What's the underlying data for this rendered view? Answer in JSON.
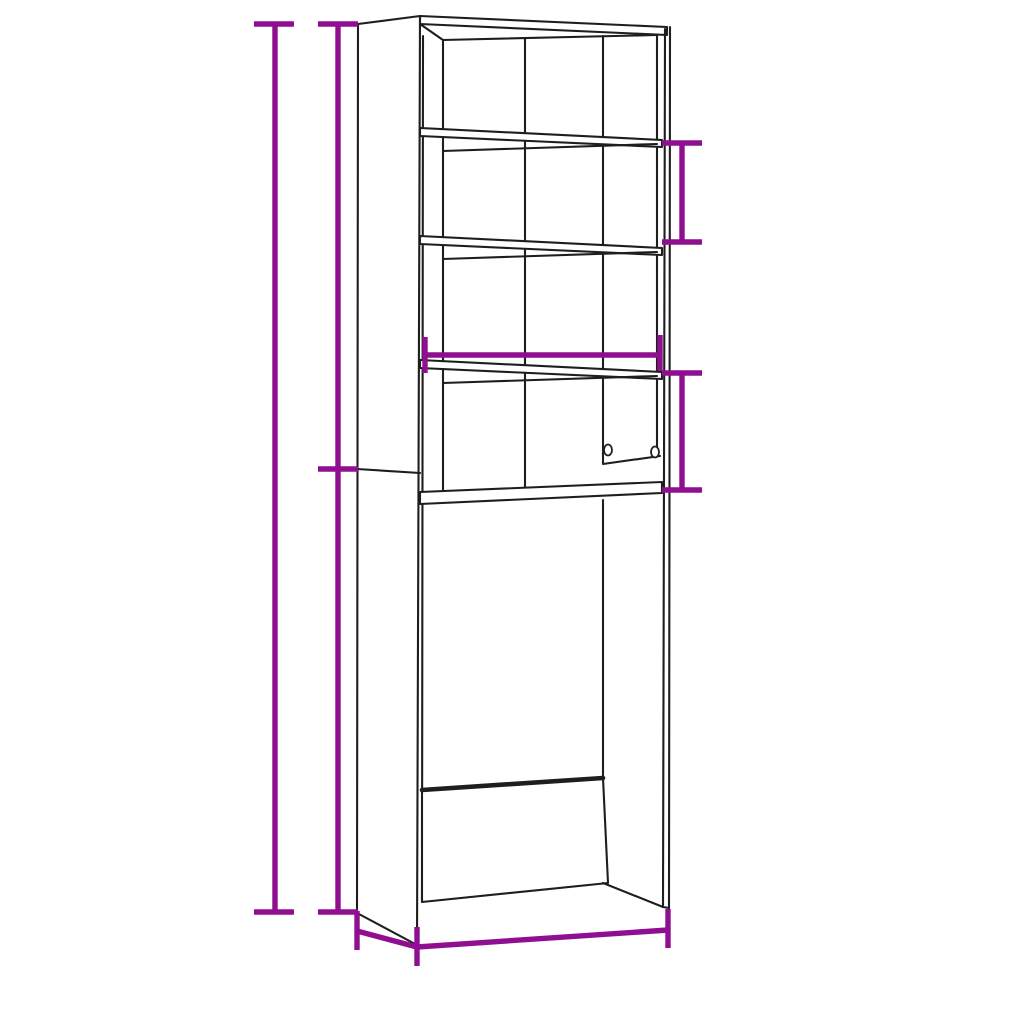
{
  "diagram": {
    "type": "product-dimension-diagram",
    "subject": "tall storage cabinet with four shelves and open washing-machine base",
    "unit_system": "cm with inch conversions",
    "colors": {
      "dimension_annotations": "#8F0F90",
      "drawing_lines": "#1E1E1E",
      "background": "#FFFFFF"
    },
    "labels": {
      "total_height": "190 cm (74.8”)",
      "upper_section_height": "95 cm (37.4”)",
      "lower_section_height": "95 cm (37.4”)",
      "top_shelf_gap": "25 cm (9.8”)",
      "middle_shelf_gap": "25 cm (9.8”)",
      "inner_width": "61 cm (24”)",
      "depth": "24 cm (9.4”)",
      "overall_width": "64 cm (25.2”)"
    }
  }
}
